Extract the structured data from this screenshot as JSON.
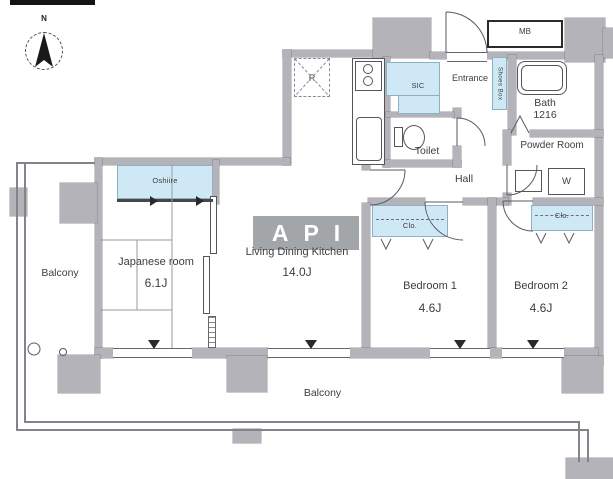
{
  "watermark": "API",
  "compass": {
    "north_label": "N"
  },
  "rooms": {
    "balcony_left": {
      "label": "Balcony"
    },
    "balcony_bottom": {
      "label": "Balcony"
    },
    "japanese_room": {
      "label": "Japanese room",
      "size": "6.1J"
    },
    "living_dining_kitchen": {
      "label": "Living Dining Kitchen",
      "size": "14.0J"
    },
    "bedroom_1": {
      "label": "Bedroom 1",
      "size": "4.6J"
    },
    "bedroom_2": {
      "label": "Bedroom 2",
      "size": "4.6J"
    },
    "hall": {
      "label": "Hall"
    },
    "toilet": {
      "label": "Toilet"
    },
    "bath": {
      "label": "Bath",
      "size": "1216"
    },
    "powder_room": {
      "label": "Powder Room"
    },
    "entrance": {
      "label": "Entrance"
    }
  },
  "fixtures": {
    "meter_box": "MB",
    "shoes_box": "Shoes Box",
    "shoe_in_closet": "SIC",
    "oshiire": "Oshiire",
    "closet_bedroom_1": "Clo.",
    "closet_bedroom_2": "Clo.",
    "washer": "W",
    "refrigerator": "R"
  },
  "colors": {
    "wall": "#b3b3b9",
    "closet_fill": "#cfe8f5",
    "watermark_bg": "#94979b"
  }
}
